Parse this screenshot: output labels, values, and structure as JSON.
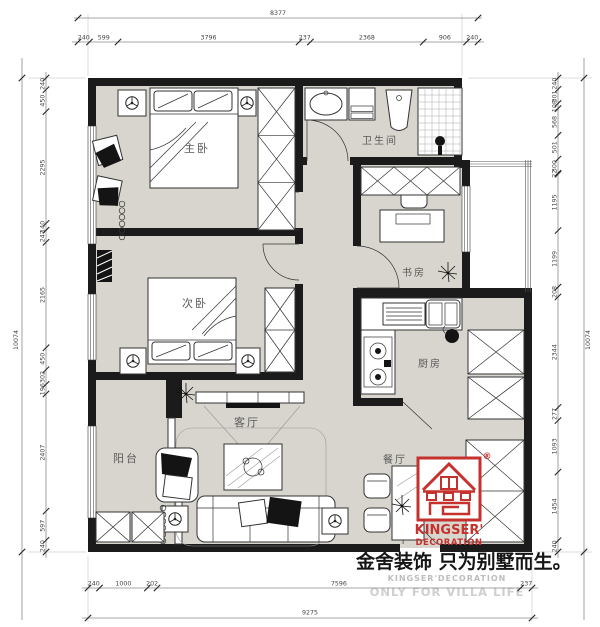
{
  "brand": {
    "logo_line1": "KINGSER'",
    "logo_line2": "DECORATION",
    "registered_mark": "®",
    "slogan": "金舍装饰 只为别墅而生。",
    "watermark_line1": "KINGSER'DECORATION",
    "watermark_line2": "ONLY FOR VILLA LIFE",
    "accent_color": "#c5322d",
    "watermark_color": "#c8c8c8"
  },
  "rooms": {
    "master_bedroom": "主卧",
    "second_bedroom": "次卧",
    "bathroom": "卫生间",
    "study": "书房",
    "kitchen": "厨房",
    "living_room": "客厅",
    "dining_room": "餐厅",
    "balcony": "阳台"
  },
  "dimensions": {
    "top": {
      "overall": "8377",
      "segments": [
        "240",
        "599",
        "3796",
        "237",
        "2368",
        "906",
        "240"
      ]
    },
    "bottom": {
      "overall": "9275",
      "segments": [
        "240",
        "1000",
        "202",
        "7596",
        "237"
      ]
    },
    "left": {
      "overall": "10074",
      "segments": [
        "240",
        "450",
        "2295",
        "140",
        "247",
        "2165",
        "450",
        "302",
        "196",
        "2407",
        "597",
        "240"
      ]
    },
    "right": {
      "overall": "10074",
      "segments": [
        "240",
        "301",
        "108",
        "568",
        "501",
        "300",
        "22",
        "1195",
        "1199",
        "208",
        "2344",
        "277",
        "1093",
        "1454",
        "240"
      ]
    }
  },
  "colors": {
    "wall": "#1b1b1b",
    "floor": "#d8d5ce",
    "line": "#555555"
  }
}
